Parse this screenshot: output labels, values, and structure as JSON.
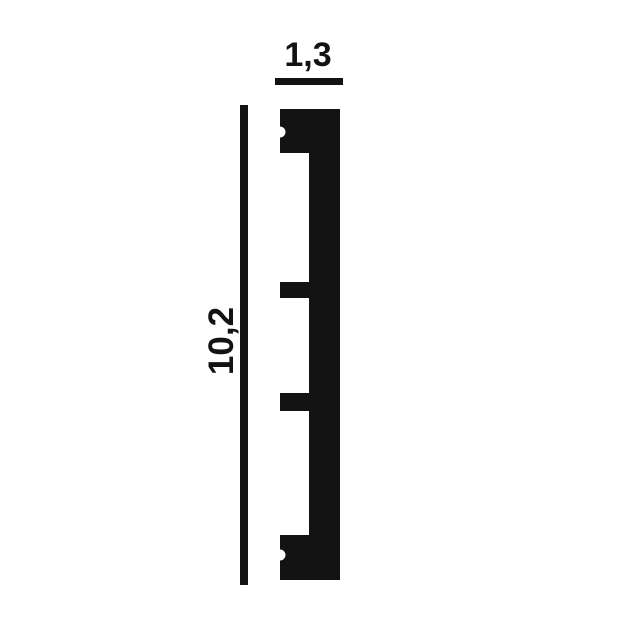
{
  "diagram": {
    "kind": "molding-profile-cross-section",
    "width_dimension": "1,3",
    "height_dimension": "10,2",
    "colors": {
      "ink": "#131313",
      "background": "#ffffff"
    }
  }
}
